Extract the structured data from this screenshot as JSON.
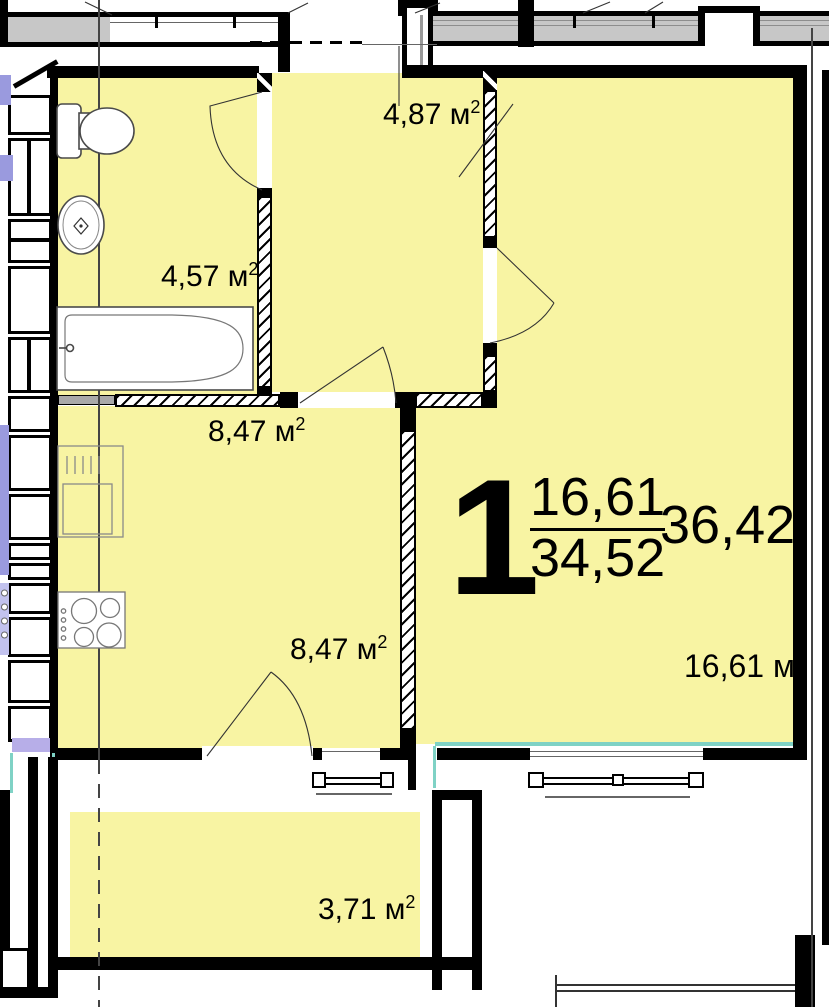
{
  "plan": {
    "rooms": {
      "hallway": {
        "area": "4,87",
        "unit": "м",
        "sup": "2"
      },
      "bathroom": {
        "area": "4,57",
        "unit": "м",
        "sup": "2"
      },
      "kitchen": {
        "area": "8,47",
        "unit": "м",
        "sup": "2"
      },
      "kitchen2": {
        "area": "8,47",
        "unit": "м",
        "sup": "2"
      },
      "living": {
        "area": "16,61",
        "unit": "м",
        "sup": "2"
      },
      "balcony": {
        "area": "3,71",
        "unit": "м",
        "sup": "2"
      }
    },
    "stamp": {
      "rooms": "1",
      "living_area": "16,61",
      "total_area": "34,52",
      "total_with_balcony": "36,42"
    },
    "colors": {
      "room_fill": "#f8f4a3",
      "wall": "#000000",
      "corridor_gray": "#c7c7c7",
      "neighbor_blue": "#9a9ade",
      "accent_teal": "#7fd2c5"
    }
  }
}
